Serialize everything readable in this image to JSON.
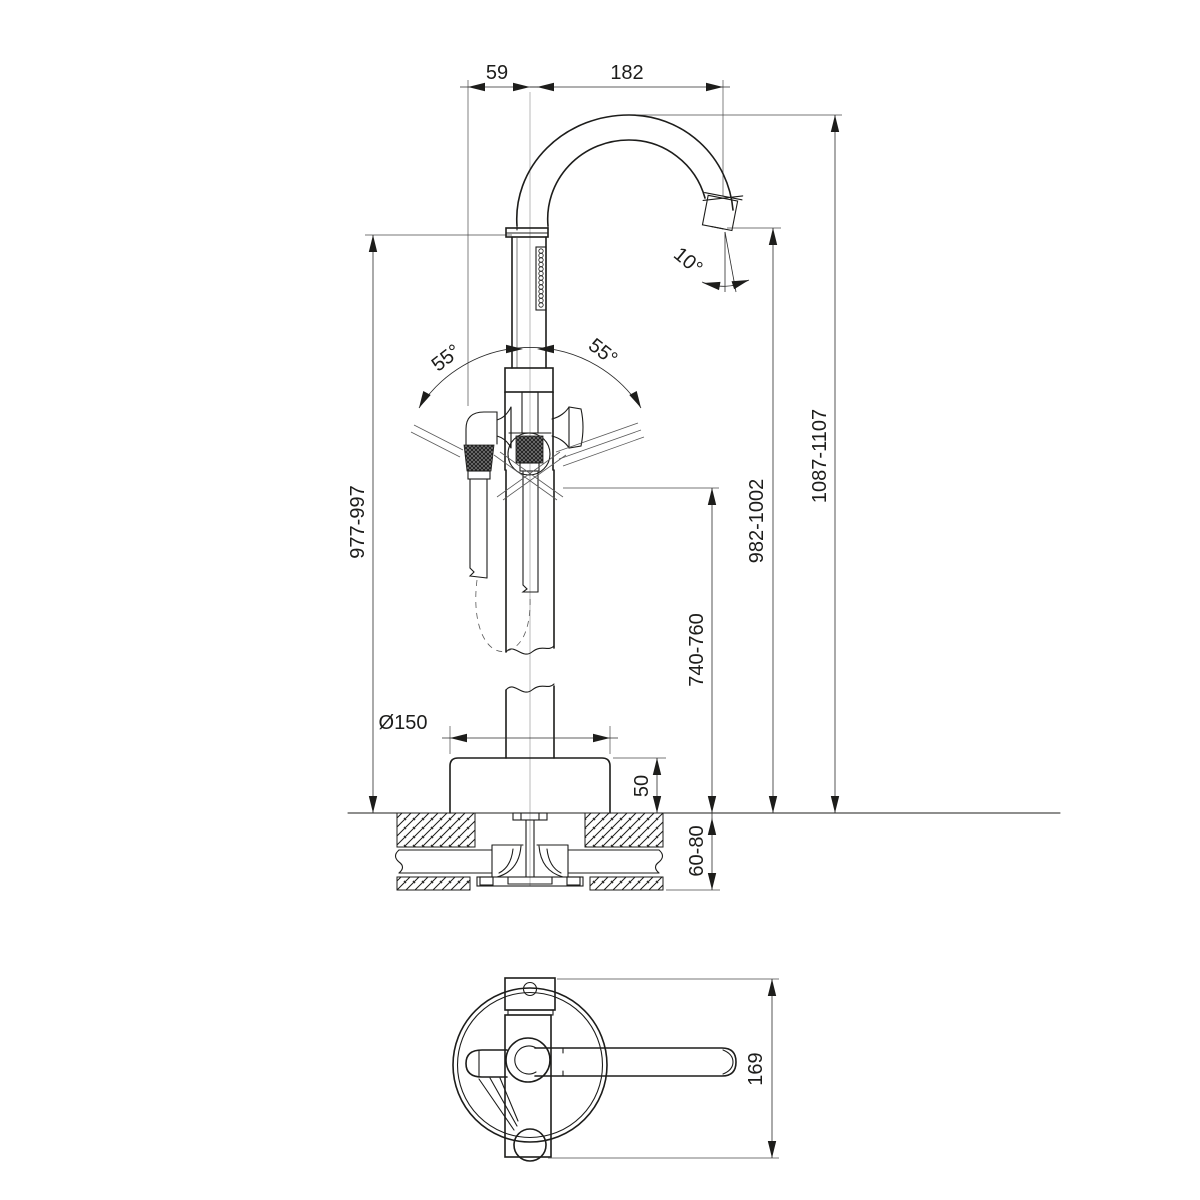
{
  "drawing": {
    "kind": "technical-dimension-drawing",
    "subject": "freestanding-bath-mixer-with-hand-shower",
    "colors": {
      "background": "#ffffff",
      "line": "#1d1d1b"
    },
    "views": {
      "front": {
        "dims": {
          "spout_offset": "59",
          "spout_reach": "182",
          "outlet_angle": "10°",
          "swing_left": "55°",
          "swing_right": "55°",
          "body_height": "977-997",
          "outlet_height": "982-1002",
          "total_height": "1087-1107",
          "lever_height": "740-760",
          "base_diameter": "Ø150",
          "base_height": "50",
          "floor_thickness": "60-80"
        }
      },
      "top": {
        "dims": {
          "overall_depth": "169"
        }
      }
    }
  }
}
